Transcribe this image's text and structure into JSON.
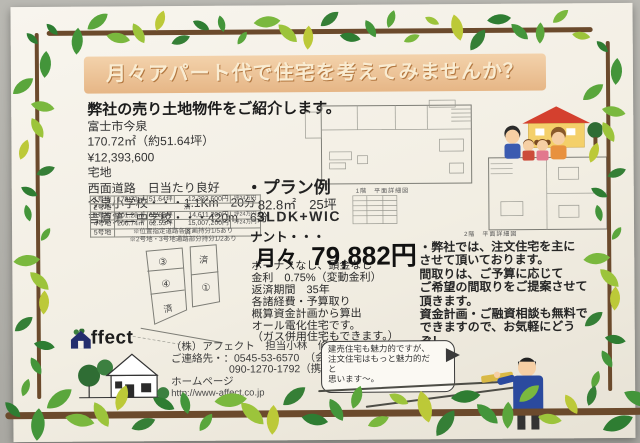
{
  "colors": {
    "paper": "#f5f1e8",
    "photo_bg": "#b3b2ac",
    "banner_bg": "#e6b686",
    "banner_text": "#f9ecd2",
    "branch": "#6b4a2c",
    "leaf_greens": [
      "#2e7d32",
      "#43953a",
      "#5aa63c",
      "#7ab83e",
      "#9cc43b",
      "#bcc938",
      "#357f36"
    ],
    "logo_navy": "#232d6e",
    "tree_green": "#2f6d34",
    "roof_red": "#d4402e",
    "house_yellow": "#f4d06a",
    "suit_blue": "#2b4a9e"
  },
  "banner": {
    "title": "月々アパート代で住宅を考えてみませんか？"
  },
  "intro": {
    "heading": "弊社の売り土地物件をご紹介します。"
  },
  "property": {
    "lines": [
      "富士市今泉",
      "170.72㎡（約51.64坪）",
      "¥12,393,600",
      "宅地",
      "西面道路　日当たり良好",
      "今泉小学校・・・1.1Km　20分",
      "吉原第二中学校・・・420m　6分"
    ]
  },
  "lots_table": {
    "rows": [
      {
        "name": "1号地",
        "area": "170.72㎡",
        "tsubo": "51.64坪",
        "price": "12,393,600円",
        "unit": "坪24万円"
      },
      {
        "name": "2号地",
        "sold": "済"
      },
      {
        "name": "3号地",
        "area": "201.28㎡",
        "tsubo": "60.88坪",
        "price": "14,611,200円",
        "unit": "坪24万円"
      },
      {
        "name": "4号地",
        "area": "206.74㎡",
        "tsubo": "62.53坪",
        "price": "15,007,200円",
        "unit": "坪24万円"
      },
      {
        "name": "5号地",
        "sold": "済"
      }
    ],
    "notes": [
      "※位置指定道路各区画持分1/5あり",
      "※2号地・3号地通路部分持分1/2あり"
    ]
  },
  "lot_map": {
    "left_labels": [
      "③",
      "④",
      "済"
    ],
    "right_labels": [
      "済",
      "①"
    ]
  },
  "plan": {
    "heading": "・プラン例",
    "size": "82.8㎡　25坪",
    "layout": "3LDK+WIC"
  },
  "payment": {
    "lead": "ナント・・・",
    "monthly_label": "月々",
    "monthly_value": "79,882円",
    "lines": [
      "ボーナスなし、頭金なし",
      "金利　0.75%（変動金利）",
      "返済期間　35年",
      "各諸経費・予算取り",
      "概算資金計画から算出",
      "オール電化住宅です。",
      "（ガス併用住宅もできます。）"
    ]
  },
  "floorplans": {
    "plan1_label": "1階　平面詳細図",
    "plan2_label": "2階　平面詳細図"
  },
  "pitch": {
    "lines": [
      "・弊社では、注文住宅を主に",
      "させて頂いております。",
      "間取りは、ご予算に応じて",
      "ご希望の間取りをご提案させて",
      "頂きます。",
      "資金計画・ご融資相談も無料で",
      "できますので、お気軽にどうぞ！"
    ]
  },
  "bubble": {
    "lines": [
      "建売住宅も魅力的ですが、",
      "注文住宅はもっと魅力的だ",
      "と",
      "思います〜。"
    ]
  },
  "logo": {
    "brand_rest": "ffect"
  },
  "contact": {
    "lines": [
      "（株）アフェクト　担当小林　修史",
      "ご連絡先・：0545-53-6570　（会社）",
      "090-1270-1792（携帯）",
      "ホームページ",
      "http://www-affect.co.jp"
    ]
  }
}
